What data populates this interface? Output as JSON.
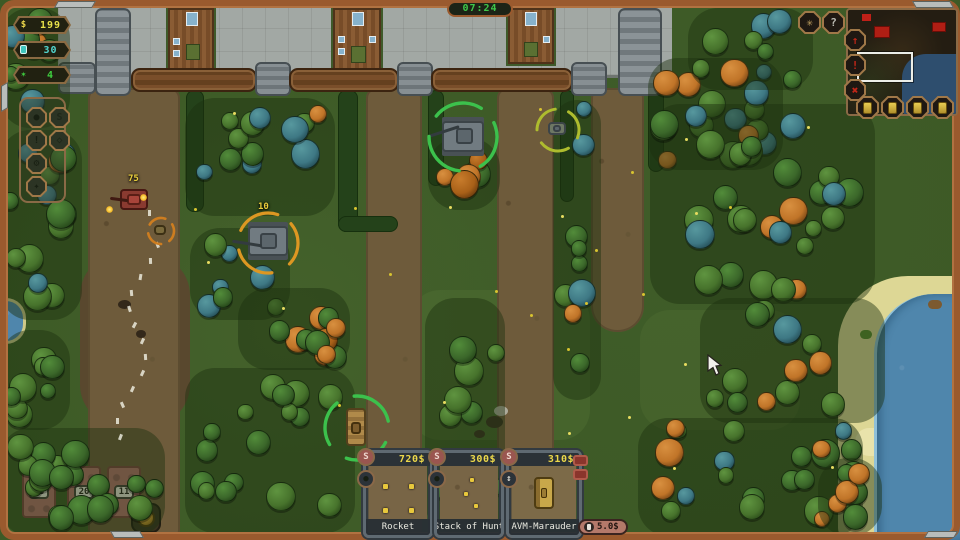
{
  "hud": {
    "money": {
      "icon": "$",
      "value": "199",
      "color": "#e8e14a"
    },
    "fuel": {
      "value": "30",
      "color": "#52d6d0"
    },
    "stars": {
      "icon": "✶",
      "value": "4",
      "color": "#3fcf3f"
    },
    "timer": "07:24"
  },
  "top_right": {
    "net_button": {
      "icon_glyph": "✳"
    },
    "help_button": {
      "label": "?"
    },
    "side_buttons": {
      "up": "↑",
      "alert": "!",
      "cancel": "✖"
    }
  },
  "left_toolbar": {
    "b1": "●",
    "b2": "S",
    "b3": "!",
    "b4": "◇",
    "b5": "⚙",
    "b6": "✦"
  },
  "shop": {
    "cards": [
      {
        "name": "Rocket",
        "price": "720$",
        "btn_top": "S"
      },
      {
        "name": "Stack of Hunt",
        "price": "300$",
        "btn_top": "S"
      },
      {
        "name": "AVM-Marauder",
        "price": "310$",
        "btn_top": "S",
        "btn_mid": "↕"
      }
    ],
    "rate": "5.0$"
  },
  "map_labels": {
    "enemy_hp": "75",
    "squad_count": "10",
    "towers": [
      "20",
      "20",
      "11"
    ]
  },
  "colors": {
    "frame": "#9a5a2e",
    "timer_text": "#3fc84a",
    "price_text": "#ecd84a",
    "select_green": "#3cc14c",
    "select_orange": "#dd9722"
  }
}
